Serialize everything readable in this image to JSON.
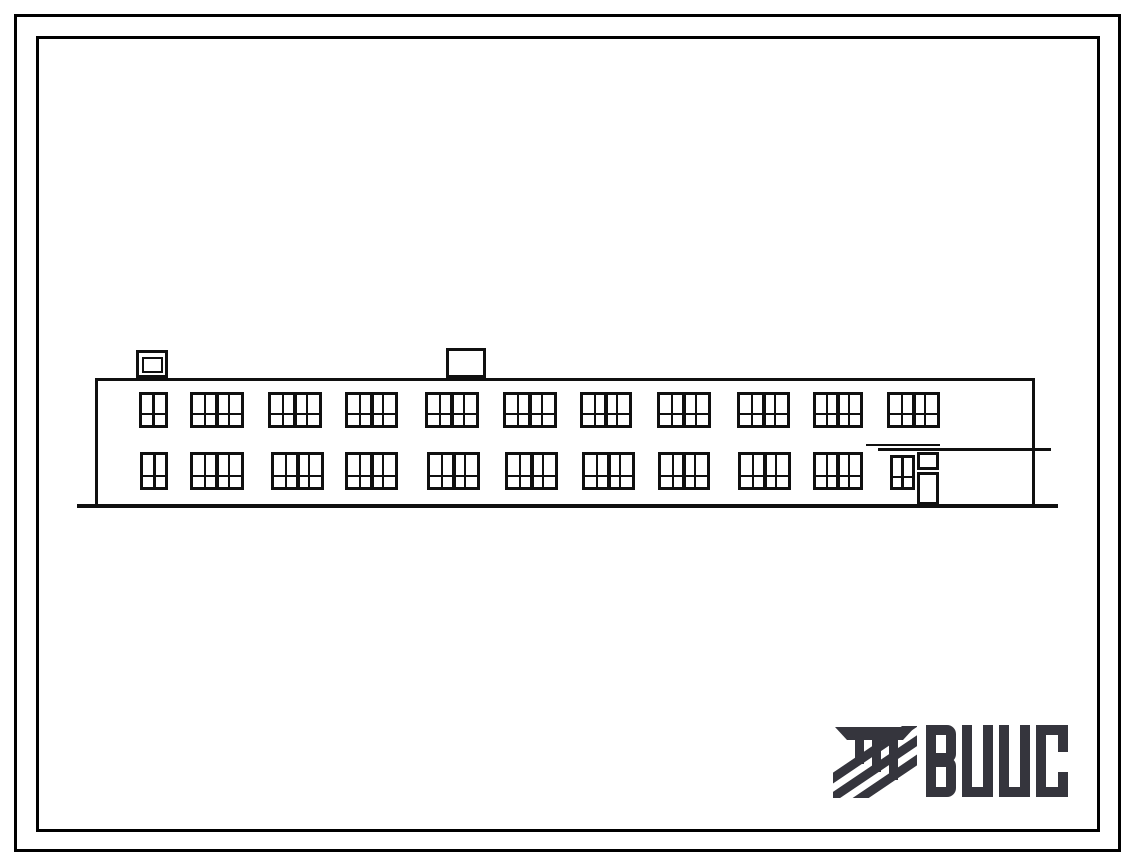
{
  "sheet": {
    "background_color": "#ffffff",
    "frame_color": "#000000"
  },
  "drawing": {
    "description": "Front elevation of a two-storey building with two rows of windows, two roof vents and an entrance door with canopy at the right end",
    "ink_color": "#101010",
    "ground": {
      "x1": 77,
      "x2": 1058,
      "y": 504,
      "thickness": 4
    },
    "body": {
      "x": 95,
      "y": 378,
      "width": 940,
      "height": 127
    },
    "chimneys": [
      {
        "x": 136,
        "y": 350,
        "w": 32,
        "h": 28,
        "inner": {
          "x": 142,
          "y": 357,
          "w": 21,
          "h": 16
        }
      },
      {
        "x": 446,
        "y": 348,
        "w": 40,
        "h": 30
      }
    ],
    "canopy_lines": [
      {
        "x1": 878,
        "y": 448,
        "x2": 1051,
        "thickness": 3
      },
      {
        "x1": 866,
        "y": 444,
        "x2": 940,
        "thickness": 2
      }
    ],
    "window_rows": [
      {
        "floor": "upper",
        "y": 392,
        "h": 36,
        "windows": [
          {
            "x": 139,
            "w": 29,
            "type": "narrow"
          },
          {
            "x": 190,
            "w": 54,
            "type": "wide"
          },
          {
            "x": 268,
            "w": 54,
            "type": "wide"
          },
          {
            "x": 345,
            "w": 53,
            "type": "wide"
          },
          {
            "x": 425,
            "w": 54,
            "type": "wide"
          },
          {
            "x": 503,
            "w": 54,
            "type": "wide"
          },
          {
            "x": 580,
            "w": 52,
            "type": "wide"
          },
          {
            "x": 657,
            "w": 54,
            "type": "wide"
          },
          {
            "x": 737,
            "w": 53,
            "type": "wide"
          },
          {
            "x": 813,
            "w": 50,
            "type": "wide"
          },
          {
            "x": 887,
            "w": 53,
            "type": "wide"
          }
        ]
      },
      {
        "floor": "lower",
        "y": 452,
        "h": 38,
        "windows": [
          {
            "x": 140,
            "w": 28,
            "type": "narrow"
          },
          {
            "x": 190,
            "w": 54,
            "type": "wide"
          },
          {
            "x": 271,
            "w": 53,
            "type": "wide"
          },
          {
            "x": 345,
            "w": 53,
            "type": "wide"
          },
          {
            "x": 427,
            "w": 53,
            "type": "wide"
          },
          {
            "x": 505,
            "w": 53,
            "type": "wide"
          },
          {
            "x": 582,
            "w": 53,
            "type": "wide"
          },
          {
            "x": 658,
            "w": 52,
            "type": "wide"
          },
          {
            "x": 738,
            "w": 53,
            "type": "wide"
          },
          {
            "x": 813,
            "w": 50,
            "type": "wide"
          }
        ]
      }
    ],
    "entrance": {
      "side_window": {
        "x": 890,
        "y": 455,
        "w": 25,
        "h": 35
      },
      "transom_window": {
        "x": 917,
        "y": 452,
        "w": 22,
        "h": 18
      },
      "door": {
        "x": 917,
        "y": 472,
        "w": 22,
        "h": 33
      }
    }
  },
  "logo": {
    "text": "ВЦИС",
    "color": "#35353d",
    "icon": "vcis-emblem-icon"
  }
}
